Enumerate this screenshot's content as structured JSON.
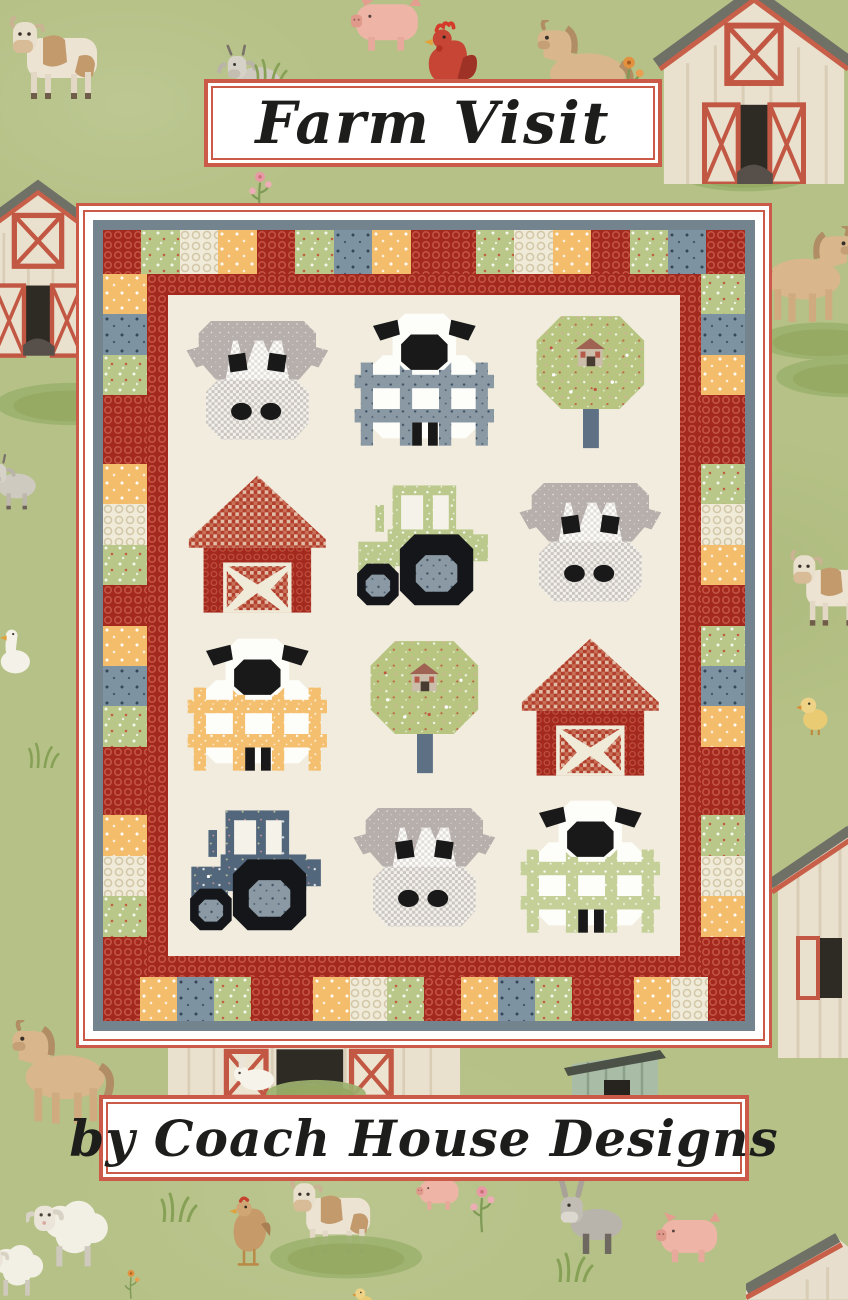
{
  "title": "Farm Visit",
  "byline": "by Coach House Designs",
  "colors": {
    "background_green": "#b5c186",
    "frame_red": "#cb5a49",
    "box_white": "#ffffff",
    "text_black": "#1d1d1b",
    "binding_blue": "#73848f",
    "border_red_print": "#a3281e",
    "quilt_cream": "#f1ecdd",
    "print_green_floral": "#bcc98c",
    "print_scenic_green": "#b7c581",
    "print_cream_honeycomb": "#f0ead8",
    "print_yellow_floral": "#f3bd6c",
    "print_blue_floral": "#7e93a1",
    "print_scenic_dark_blue": "#53677c",
    "cow_gray": "#b6afac",
    "black_patch": "#191919",
    "red_gingham": "#b23e2c",
    "fence_blue": "#8a99a3",
    "fence_yellow": "#f4c070",
    "fence_green": "#c5d098",
    "trunk_blue": "#5d7084"
  },
  "quilt": {
    "blocks": [
      {
        "type": "cow"
      },
      {
        "type": "sheep",
        "fence": "blue"
      },
      {
        "type": "tree"
      },
      {
        "type": "barn"
      },
      {
        "type": "tractor",
        "body": "green"
      },
      {
        "type": "cow"
      },
      {
        "type": "sheep",
        "fence": "yellow"
      },
      {
        "type": "tree"
      },
      {
        "type": "barn"
      },
      {
        "type": "tractor",
        "body": "darkblue"
      },
      {
        "type": "cow"
      },
      {
        "type": "sheep",
        "fence": "green"
      }
    ],
    "border_top": [
      "red",
      "green",
      "cream",
      "yellow",
      "red",
      "green",
      "blue",
      "yellow",
      "red2",
      "green",
      "cream",
      "yellow",
      "red",
      "green",
      "blue",
      "red"
    ],
    "border_bottom": [
      "red",
      "yellow",
      "blue",
      "green",
      "red2",
      "yellow",
      "cream",
      "green",
      "red",
      "yellow",
      "blue",
      "green",
      "red2",
      "yellow",
      "cream",
      "red"
    ],
    "border_left": [
      "yellow",
      "blue",
      "green",
      "red2",
      "yellow",
      "cream",
      "green",
      "red",
      "yellow",
      "blue",
      "green",
      "red2",
      "yellow",
      "cream",
      "green",
      "red"
    ],
    "border_right": [
      "green",
      "blue",
      "yellow",
      "red2",
      "green",
      "cream",
      "yellow",
      "red",
      "green",
      "blue",
      "yellow",
      "red2",
      "green",
      "cream",
      "yellow",
      "red"
    ]
  },
  "background": {
    "motifs": [
      {
        "type": "cow",
        "x": 8,
        "y": 14,
        "w": 112,
        "h": 92
      },
      {
        "type": "goat",
        "x": 216,
        "y": 44,
        "w": 76,
        "h": 68
      },
      {
        "type": "pig",
        "x": 344,
        "y": -6,
        "w": 86,
        "h": 60
      },
      {
        "type": "rooster",
        "x": 406,
        "y": 20,
        "w": 80,
        "h": 90
      },
      {
        "type": "horse",
        "x": 512,
        "y": 20,
        "w": 126,
        "h": 104
      },
      {
        "type": "flower-orange",
        "x": 614,
        "y": 50,
        "w": 30,
        "h": 58
      },
      {
        "type": "grass-patch",
        "x": 636,
        "y": 150,
        "w": 220,
        "h": 44
      },
      {
        "type": "barn-front",
        "x": 648,
        "y": -14,
        "w": 212,
        "h": 198
      },
      {
        "type": "flower-pink",
        "x": 246,
        "y": 166,
        "w": 28,
        "h": 50
      },
      {
        "type": "grass-tuft",
        "x": 252,
        "y": 58,
        "w": 36,
        "h": 28
      },
      {
        "type": "barn-front",
        "x": -54,
        "y": 126,
        "w": 184,
        "h": 284
      },
      {
        "type": "grass-patch",
        "x": -24,
        "y": 380,
        "w": 190,
        "h": 48
      },
      {
        "type": "goat",
        "x": -20,
        "y": 450,
        "w": 66,
        "h": 66
      },
      {
        "type": "goose",
        "x": -6,
        "y": 618,
        "w": 42,
        "h": 62
      },
      {
        "type": "grass-tuft",
        "x": 26,
        "y": 742,
        "w": 34,
        "h": 26
      },
      {
        "type": "horse",
        "x": 754,
        "y": 226,
        "w": 124,
        "h": 102,
        "flip": true
      },
      {
        "type": "grass-patch",
        "x": 748,
        "y": 320,
        "w": 150,
        "h": 42
      },
      {
        "type": "grass-patch",
        "x": 768,
        "y": 354,
        "w": 160,
        "h": 46
      },
      {
        "type": "cow",
        "x": 788,
        "y": 548,
        "w": 104,
        "h": 84
      },
      {
        "type": "chick",
        "x": 794,
        "y": 688,
        "w": 40,
        "h": 48
      },
      {
        "type": "barn-sliver",
        "x": 768,
        "y": 818,
        "w": 82,
        "h": 240
      },
      {
        "type": "horse",
        "x": -18,
        "y": 1020,
        "w": 140,
        "h": 110
      },
      {
        "type": "barn-wide",
        "x": 168,
        "y": 1034,
        "w": 292,
        "h": 64
      },
      {
        "type": "grass-patch",
        "x": 148,
        "y": 1078,
        "w": 336,
        "h": 32
      },
      {
        "type": "shed",
        "x": 560,
        "y": 1042,
        "w": 110,
        "h": 80
      },
      {
        "type": "bunny",
        "x": 230,
        "y": 1056,
        "w": 48,
        "h": 36
      },
      {
        "type": "lamb",
        "x": 26,
        "y": 1184,
        "w": 96,
        "h": 88
      },
      {
        "type": "lamb",
        "x": -20,
        "y": 1232,
        "w": 74,
        "h": 68
      },
      {
        "type": "hen",
        "x": 220,
        "y": 1190,
        "w": 60,
        "h": 88
      },
      {
        "type": "cow",
        "x": 288,
        "y": 1176,
        "w": 104,
        "h": 84
      },
      {
        "type": "grass-patch",
        "x": 268,
        "y": 1232,
        "w": 156,
        "h": 50
      },
      {
        "type": "flower-pink",
        "x": 468,
        "y": 1180,
        "w": 28,
        "h": 54
      },
      {
        "type": "donkey",
        "x": 546,
        "y": 1180,
        "w": 92,
        "h": 78
      },
      {
        "type": "pig",
        "x": 650,
        "y": 1210,
        "w": 78,
        "h": 56
      },
      {
        "type": "pig",
        "x": 412,
        "y": 1174,
        "w": 54,
        "h": 38
      },
      {
        "type": "chick",
        "x": 346,
        "y": 1282,
        "w": 36,
        "h": 32
      },
      {
        "type": "roof-corner",
        "x": 746,
        "y": 1224,
        "w": 102,
        "h": 76
      },
      {
        "type": "grass-tuft",
        "x": 158,
        "y": 1192,
        "w": 40,
        "h": 30
      },
      {
        "type": "grass-tuft",
        "x": 554,
        "y": 1252,
        "w": 40,
        "h": 30
      },
      {
        "type": "flower-orange",
        "x": 118,
        "y": 1266,
        "w": 26,
        "h": 34
      }
    ]
  }
}
